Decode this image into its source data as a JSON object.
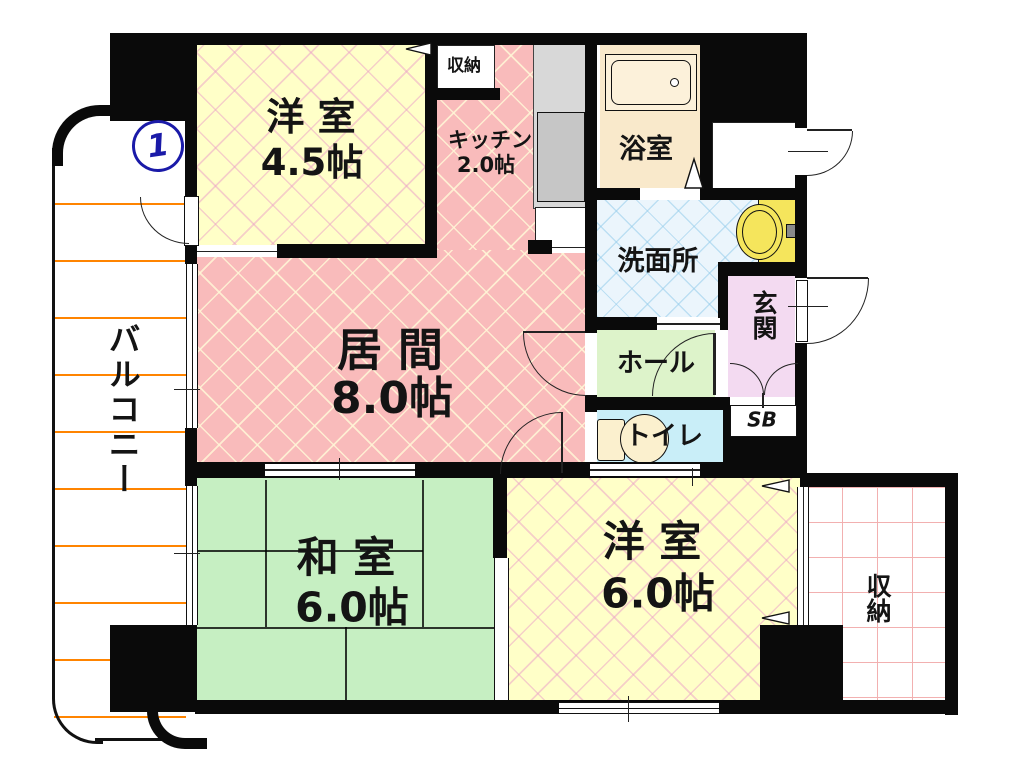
{
  "plan": {
    "unit_marker": "1",
    "balcony": {
      "label": "バルコニー"
    },
    "rooms": {
      "western_room_1": {
        "name": "洋 室",
        "size": "4.5帖"
      },
      "kitchen": {
        "name": "キッチン",
        "size": "2.0帖"
      },
      "bathroom": {
        "name": "浴室"
      },
      "washroom": {
        "name": "洗面所"
      },
      "living_room": {
        "name": "居 間",
        "size": "8.0帖"
      },
      "hall": {
        "name": "ホール"
      },
      "entrance": {
        "name": "玄関"
      },
      "shoe_box": {
        "name": "SB"
      },
      "toilet": {
        "name": "トイレ"
      },
      "japanese_room": {
        "name": "和 室",
        "size": "6.0帖"
      },
      "western_room_2": {
        "name": "洋 室",
        "size": "6.0帖"
      },
      "storage_top": {
        "name": "収納"
      },
      "storage_right": {
        "name": "収納"
      }
    },
    "colors": {
      "wall": "#0A0A0A",
      "western_room": "#FFFFC8",
      "living_room": "#F9BBBB",
      "japanese_room": "#C6EFC2",
      "hall": "#DDF3CA",
      "toilet": "#C9EEF8",
      "washroom": "#EBF5FC",
      "entrance": "#F3DAF1",
      "bathroom": "#F9E9CB",
      "sink": "#F5E55C",
      "balcony_line": "#FF8400",
      "storage_grid": "#F2B0B0",
      "unit_marker_blue": "#1A1AA8",
      "counter_gray": "#D8D8D8"
    }
  }
}
